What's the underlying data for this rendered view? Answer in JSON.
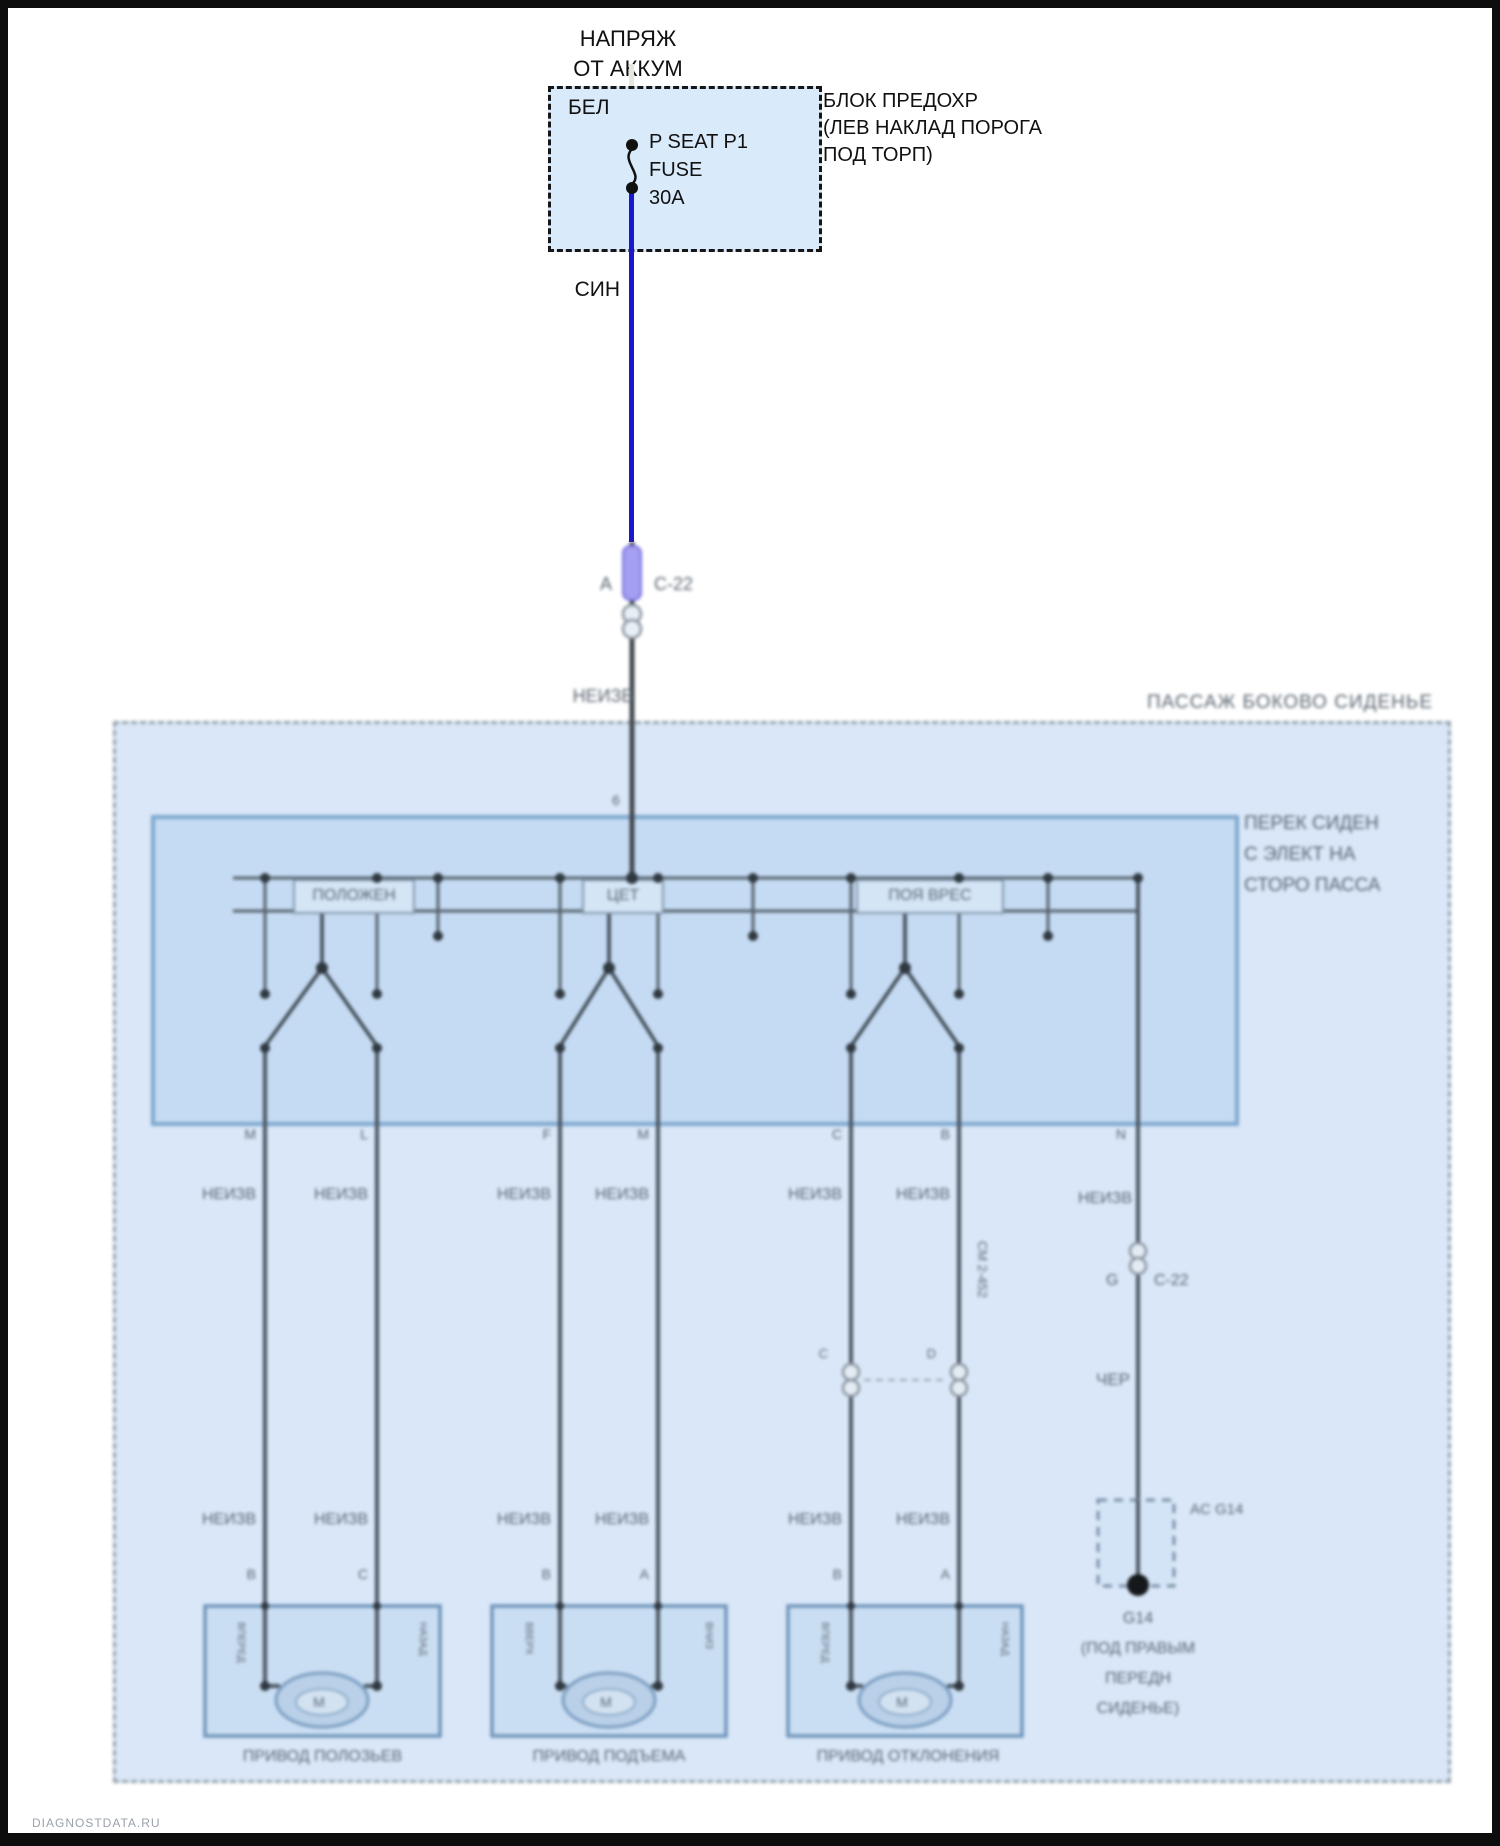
{
  "header": {
    "line1": "НАПРЯЖ",
    "line2": "ОТ АККУМ"
  },
  "fuse_box": {
    "wire_in_color": "БЕЛ",
    "fuse_line1": "P SEAT P1",
    "fuse_line2": "FUSE",
    "fuse_line3": "30A",
    "name_line1": "БЛОК ПРЕДОХР",
    "name_line2": "(ЛЕВ НАКЛАД ПОРОГА",
    "name_line3": "ПОД ТОРП)"
  },
  "feed_wire": {
    "color_label": "СИН",
    "connector_pin": "A",
    "connector_name": "C-22",
    "color_after_connector": "НЕИЗВ",
    "switch_entry_pin": "6"
  },
  "region": {
    "title": "ПАССАЖ БОКОВО СИДЕНЬЕ"
  },
  "switch_box": {
    "name_line1": "ПЕРЕК СИДЕН",
    "name_line2": "С ЭЛЕКТ НА",
    "name_line3": "СТОРО ПАССА",
    "sections": [
      "ПОЛОЖЕН",
      "ЦЕТ",
      "ПОЯ ВРЕС"
    ]
  },
  "pins": {
    "top": [
      "M",
      "L",
      "F",
      "M",
      "C",
      "B"
    ],
    "right_top": "N",
    "bottom": [
      "B",
      "C",
      "B",
      "A",
      "B",
      "A"
    ],
    "inline_left": "C",
    "inline_right": "D",
    "ground_connector_pin": "G"
  },
  "wire_labels": {
    "upper": [
      "НЕИЗВ",
      "НЕИЗВ",
      "НЕИЗВ",
      "НЕИЗВ",
      "НЕИЗВ",
      "НЕИЗВ"
    ],
    "lower": [
      "НЕИЗВ",
      "НЕИЗВ",
      "НЕИЗВ",
      "НЕИЗВ",
      "НЕИЗВ",
      "НЕИЗВ"
    ],
    "right_upper": "НЕИЗВ",
    "right_lower": "ЧЕР",
    "vertical_note": "СМ 2-452",
    "inline_connector_name": "C-22"
  },
  "motors": [
    {
      "label": "ПРИВОД ПОЛОЗЬЕВ",
      "left_dir": "ВПЕРЕД",
      "right_dir": "НАЗАД",
      "symbol": "M"
    },
    {
      "label": "ПРИВОД ПОДЪЕМА",
      "left_dir": "ВВЕРХ",
      "right_dir": "ВНИЗ",
      "symbol": "M"
    },
    {
      "label": "ПРИВОД ОТКЛОНЕНИЯ",
      "left_dir": "ВПЕРЕД",
      "right_dir": "НАЗАД",
      "symbol": "M"
    }
  ],
  "ground": {
    "connector_label": "AC G14",
    "name": "G14",
    "location_line1": "(ПОД ПРАВЫМ",
    "location_line2": "ПЕРЕДН",
    "location_line3": "СИДЕНЬЕ)"
  },
  "watermark": "DIAGNOSTDATA.RU",
  "colors": {
    "wire_blue": "#1a17cf",
    "wire_white": "#e9e6e1",
    "wire_dark": "#49545f",
    "region_fill": "#d9e7f8",
    "switch_box_fill": "#c5dbf3",
    "fuse_box_fill": "#d9eafb"
  }
}
